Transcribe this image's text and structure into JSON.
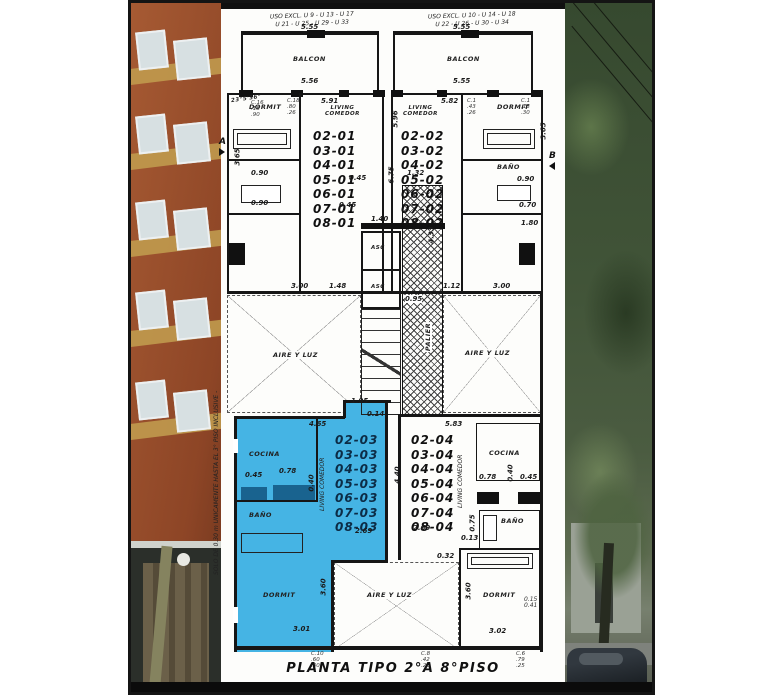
{
  "colors": {
    "highlight_unit": "#45b4e4",
    "plan_line": "#161616"
  },
  "title": "PLANTA TIPO 2°A 8°PISO",
  "notes": {
    "top_left_1": "USO EXCL. U 9 - U 13 - U 17",
    "top_left_2": "U 21 - U 25 - U 29 - U 33",
    "top_right_1": "USO EXCL. U 10 - U 14 - U 18",
    "top_right_2": "U 22 - U 26 - U 30 - U 34",
    "side": "SOLO DE 0.30 m UNICAMENTE HASTA EL 3° PISO INCLUSIVE -",
    "angle": "23°5'36\""
  },
  "labels": {
    "balcon": "BALCON",
    "dormit": "DORMIT",
    "living": "LIVING",
    "comedor": "COMEDOR",
    "bano": "BAÑO",
    "cocina": "COCINA",
    "aire": "AIRE Y LUZ",
    "palier": "PALIER",
    "asc": "ASC"
  },
  "markers": {
    "a": "A",
    "b": "B"
  },
  "unit_lists": {
    "u01": [
      "02-01",
      "03-01",
      "04-01",
      "05-01",
      "06-01",
      "07-01",
      "08-01"
    ],
    "u02": [
      "02-02",
      "03-02",
      "04-02",
      "05-02",
      "06-02",
      "07-02",
      "08-02"
    ],
    "u03": [
      "02-03",
      "03-03",
      "04-03",
      "05-03",
      "06-03",
      "07-03",
      "08-03"
    ],
    "u04": [
      "02-04",
      "03-04",
      "04-04",
      "05-04",
      "06-04",
      "07-04",
      "08-04"
    ]
  },
  "dims": {
    "balcon_l": "5.55",
    "balcon_l_in": "5.56",
    "balcon_r": "5.55",
    "balcon_r_in": "5.55",
    "liv1_w": "5.91",
    "liv2_w": "5.82",
    "mid_h1": "5.96",
    "mid_h2": "6.75",
    "dorm1_h": "3.65",
    "dorm1_w": "3.00",
    "p148": "1.48",
    "dorm2_w": "3.00",
    "dorm2_h": "3.65",
    "p112": "1.12",
    "p090a": "0.90",
    "p090b": "0.90",
    "p090c": "0.90",
    "p070": "0.70",
    "p180": "1.80",
    "asc045a": "0.45",
    "asc045b": "0.45",
    "asc140": "1.40",
    "p132": "1.32",
    "palier_h": "4.33",
    "p095": "0.95",
    "coc3_w": "4.65",
    "p045_3": "0.45",
    "p078_3": "0.78",
    "p040_3": "0.40",
    "p269_3": "2.69",
    "p583": "5.83",
    "p440": "4.40",
    "p195": "1.95",
    "p014": "0.14",
    "p078_4a": "0.78",
    "p040_4": "0.40",
    "p045_4a": "0.45",
    "p078_4b": "0.78",
    "p045_4b": "0.45",
    "p075": "0.75",
    "p269_4": "2.69",
    "dorm3_w": "3.01",
    "dorm3_h": "3.60",
    "dorm4_w": "3.02",
    "dorm4_h": "3.60",
    "p013": "0.13",
    "p032": "0.32",
    "p015": "0.15",
    "p041": "0.41"
  },
  "stacks": {
    "s1": [
      "C.16",
      ".18",
      ".90"
    ],
    "s2": [
      "C.18",
      ".80",
      ".26"
    ],
    "s3": [
      "C.1",
      ".43",
      ".26"
    ],
    "s4": [
      "C.1",
      ".18",
      ".30"
    ],
    "s5": [
      "C.10",
      ".60",
      ".30"
    ],
    "s6": [
      "C.8",
      ".42",
      ".26"
    ],
    "s7": [
      "C.6",
      ".79",
      ".25"
    ],
    "sr": [
      "0.15",
      "0.41"
    ]
  }
}
